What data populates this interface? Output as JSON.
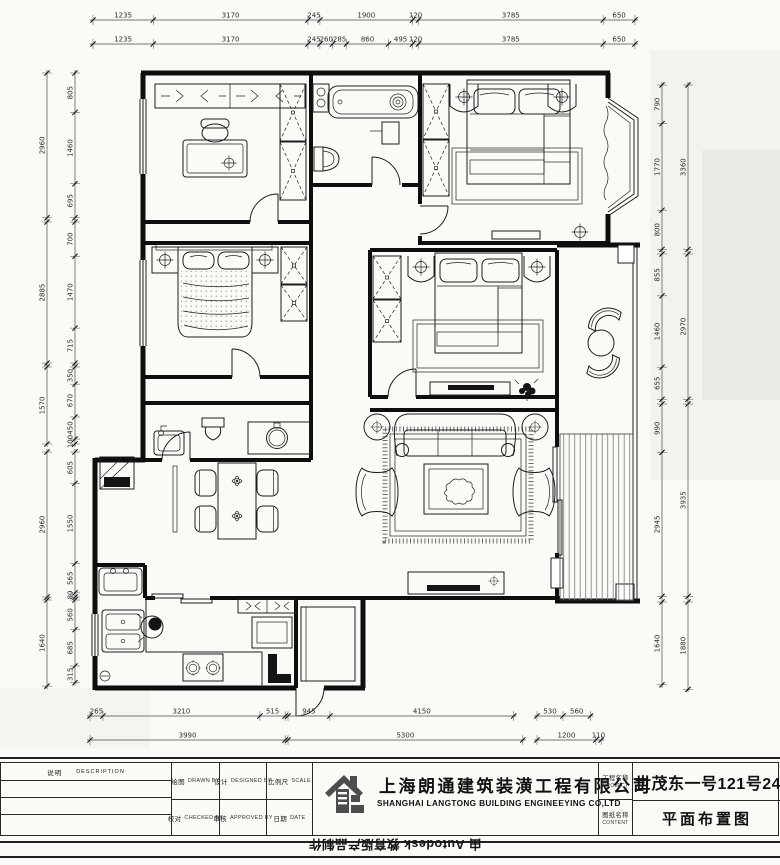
{
  "title_block": {
    "description_label": "说明",
    "description_label_en": "DESCRIPTION",
    "drawn_by": "绘图",
    "drawn_by_en": "DRAWN BY",
    "designed_by": "设计",
    "designed_by_en": "DESIGNED BY",
    "scale_label": "比例尺",
    "scale_en": "SCALE",
    "checked_by": "校对",
    "checked_by_en": "CHECKED BY",
    "approved_by": "审核",
    "approved_by_en": "APPROVED BY",
    "date_label": "日期",
    "date_en": "DATE",
    "company_cn": "上海朗通建筑装潢工程有限公司",
    "company_en": "SHANGHAI LANGTONG BUILDING ENGINEEYING CO,LTD",
    "project_label_cn": "工程名称",
    "project_label_en": "PROJECT",
    "content_label_cn": "图纸名称",
    "content_label_en": "CONTENT",
    "project_name": "世茂东一号121号2401室",
    "drawing_name": "平面布置图"
  },
  "watermark": "由 Autodesk 教育版产品制作",
  "dimensions": {
    "chains": [
      {
        "side": "top",
        "dir": "h",
        "line": 20,
        "start": 93,
        "scale": 0.0488,
        "values": [
          1235,
          3170,
          245,
          1900,
          120,
          3785,
          650
        ]
      },
      {
        "side": "top",
        "dir": "h",
        "line": 44,
        "start": 93,
        "scale": 0.0488,
        "values": [
          1235,
          3170,
          245,
          260,
          285,
          860,
          495,
          120,
          3785,
          650
        ]
      },
      {
        "side": "bottom",
        "dir": "h",
        "line": 716,
        "start": 90,
        "scale": 0.0489,
        "values": [
          265,
          3210,
          515
        ]
      },
      {
        "side": "bottom",
        "dir": "h",
        "line": 716,
        "start": 288,
        "scale": 0.0443,
        "values": [
          945,
          4150
        ]
      },
      {
        "side": "bottom",
        "dir": "h",
        "line": 716,
        "start": 537,
        "scale": 0.049,
        "values": [
          530,
          560
        ]
      },
      {
        "side": "bottom",
        "dir": "h",
        "line": 740,
        "start": 90,
        "scale": 0.0489,
        "values": [
          3990
        ]
      },
      {
        "side": "bottom",
        "dir": "h",
        "line": 740,
        "start": 288,
        "scale": 0.0443,
        "values": [
          5300
        ]
      },
      {
        "side": "bottom",
        "dir": "h",
        "line": 740,
        "start": 537,
        "scale": 0.049,
        "values": [
          1200,
          110
        ]
      },
      {
        "side": "left",
        "dir": "v",
        "line": 75,
        "start": 73,
        "scale": 0.0489,
        "values": [
          805,
          1460,
          695
        ]
      },
      {
        "side": "left",
        "dir": "v",
        "line": 47,
        "start": 73,
        "scale": 0.0489,
        "values": [
          2960
        ]
      },
      {
        "side": "left",
        "dir": "v",
        "line": 75,
        "start": 222,
        "scale": 0.0489,
        "values": [
          700,
          1470,
          715
        ]
      },
      {
        "side": "left",
        "dir": "v",
        "line": 47,
        "start": 222,
        "scale": 0.0489,
        "values": [
          2885
        ]
      },
      {
        "side": "left",
        "dir": "v",
        "line": 75,
        "start": 367,
        "scale": 0.049,
        "values": [
          350,
          670,
          450,
          100
        ]
      },
      {
        "side": "left",
        "dir": "v",
        "line": 47,
        "start": 367,
        "scale": 0.049,
        "values": [
          1570
        ]
      },
      {
        "side": "left",
        "dir": "v",
        "line": 75,
        "start": 452,
        "scale": 0.0518,
        "values": [
          605,
          1550,
          565,
          80
        ]
      },
      {
        "side": "left",
        "dir": "v",
        "line": 47,
        "start": 452,
        "scale": 0.049,
        "values": [
          2960
        ]
      },
      {
        "side": "left",
        "dir": "v",
        "line": 75,
        "start": 600,
        "scale": 0.053,
        "values": [
          560,
          685,
          315
        ]
      },
      {
        "side": "left",
        "dir": "v",
        "line": 47,
        "start": 600,
        "scale": 0.0525,
        "values": [
          1640
        ]
      },
      {
        "side": "right",
        "dir": "v",
        "line": 662,
        "start": 85,
        "scale": 0.0489,
        "values": [
          790,
          1770,
          800
        ]
      },
      {
        "side": "right",
        "dir": "v",
        "line": 688,
        "start": 85,
        "scale": 0.0489,
        "values": [
          3360
        ]
      },
      {
        "side": "right",
        "dir": "v",
        "line": 662,
        "start": 254,
        "scale": 0.0489,
        "values": [
          855,
          1460,
          655
        ]
      },
      {
        "side": "right",
        "dir": "v",
        "line": 688,
        "start": 254,
        "scale": 0.0489,
        "values": [
          2970
        ]
      },
      {
        "side": "right",
        "dir": "v",
        "line": 662,
        "start": 404,
        "scale": 0.0489,
        "values": [
          990,
          2945
        ]
      },
      {
        "side": "right",
        "dir": "v",
        "line": 688,
        "start": 404,
        "scale": 0.0489,
        "values": [
          3935
        ]
      },
      {
        "side": "right",
        "dir": "v",
        "line": 662,
        "start": 602,
        "scale": 0.0505,
        "values": [
          1640
        ]
      },
      {
        "side": "right",
        "dir": "v",
        "line": 688,
        "start": 602,
        "scale": 0.0465,
        "values": [
          1880
        ]
      }
    ]
  }
}
